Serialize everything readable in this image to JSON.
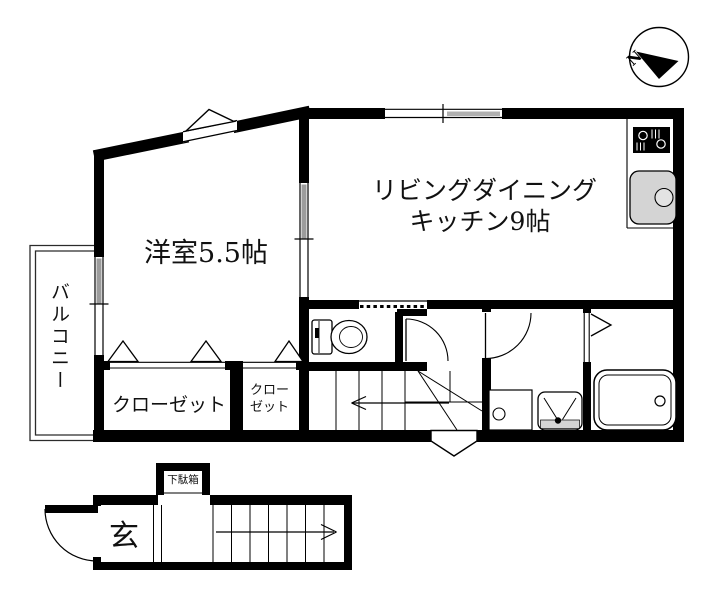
{
  "document": {
    "type": "apartment-floor-plan"
  },
  "compass": {
    "north_label": "N"
  },
  "second_floor": {
    "western_room_label": "洋室5.5帖",
    "ldk_label_line1": "リビングダイニング",
    "ldk_label_line2": "キッチン9帖",
    "balcony_label": "バルコニー",
    "closet_large_label": "クローゼット",
    "closet_small_line1": "クロー",
    "closet_small_line2": "ゼット"
  },
  "first_floor": {
    "entrance_label": "玄",
    "shoe_cabinet_label": "下駄箱"
  },
  "icons": {
    "compass": "circle-with-black-north-needle",
    "stove": "gas-stove-top",
    "sink": "kitchen-sink",
    "toilet": "western-toilet",
    "washing_machine": "washing-machine-pan",
    "washbasin": "washbasin",
    "bathtub": "bathtub",
    "closet_doors": "folding-door-triangles",
    "bay_window": "triangular-bay-window"
  },
  "colors": {
    "wall": "#000000",
    "background": "#ffffff",
    "fixture_gray": "#d4d4d4",
    "window_gray": "#9c9c9c"
  }
}
